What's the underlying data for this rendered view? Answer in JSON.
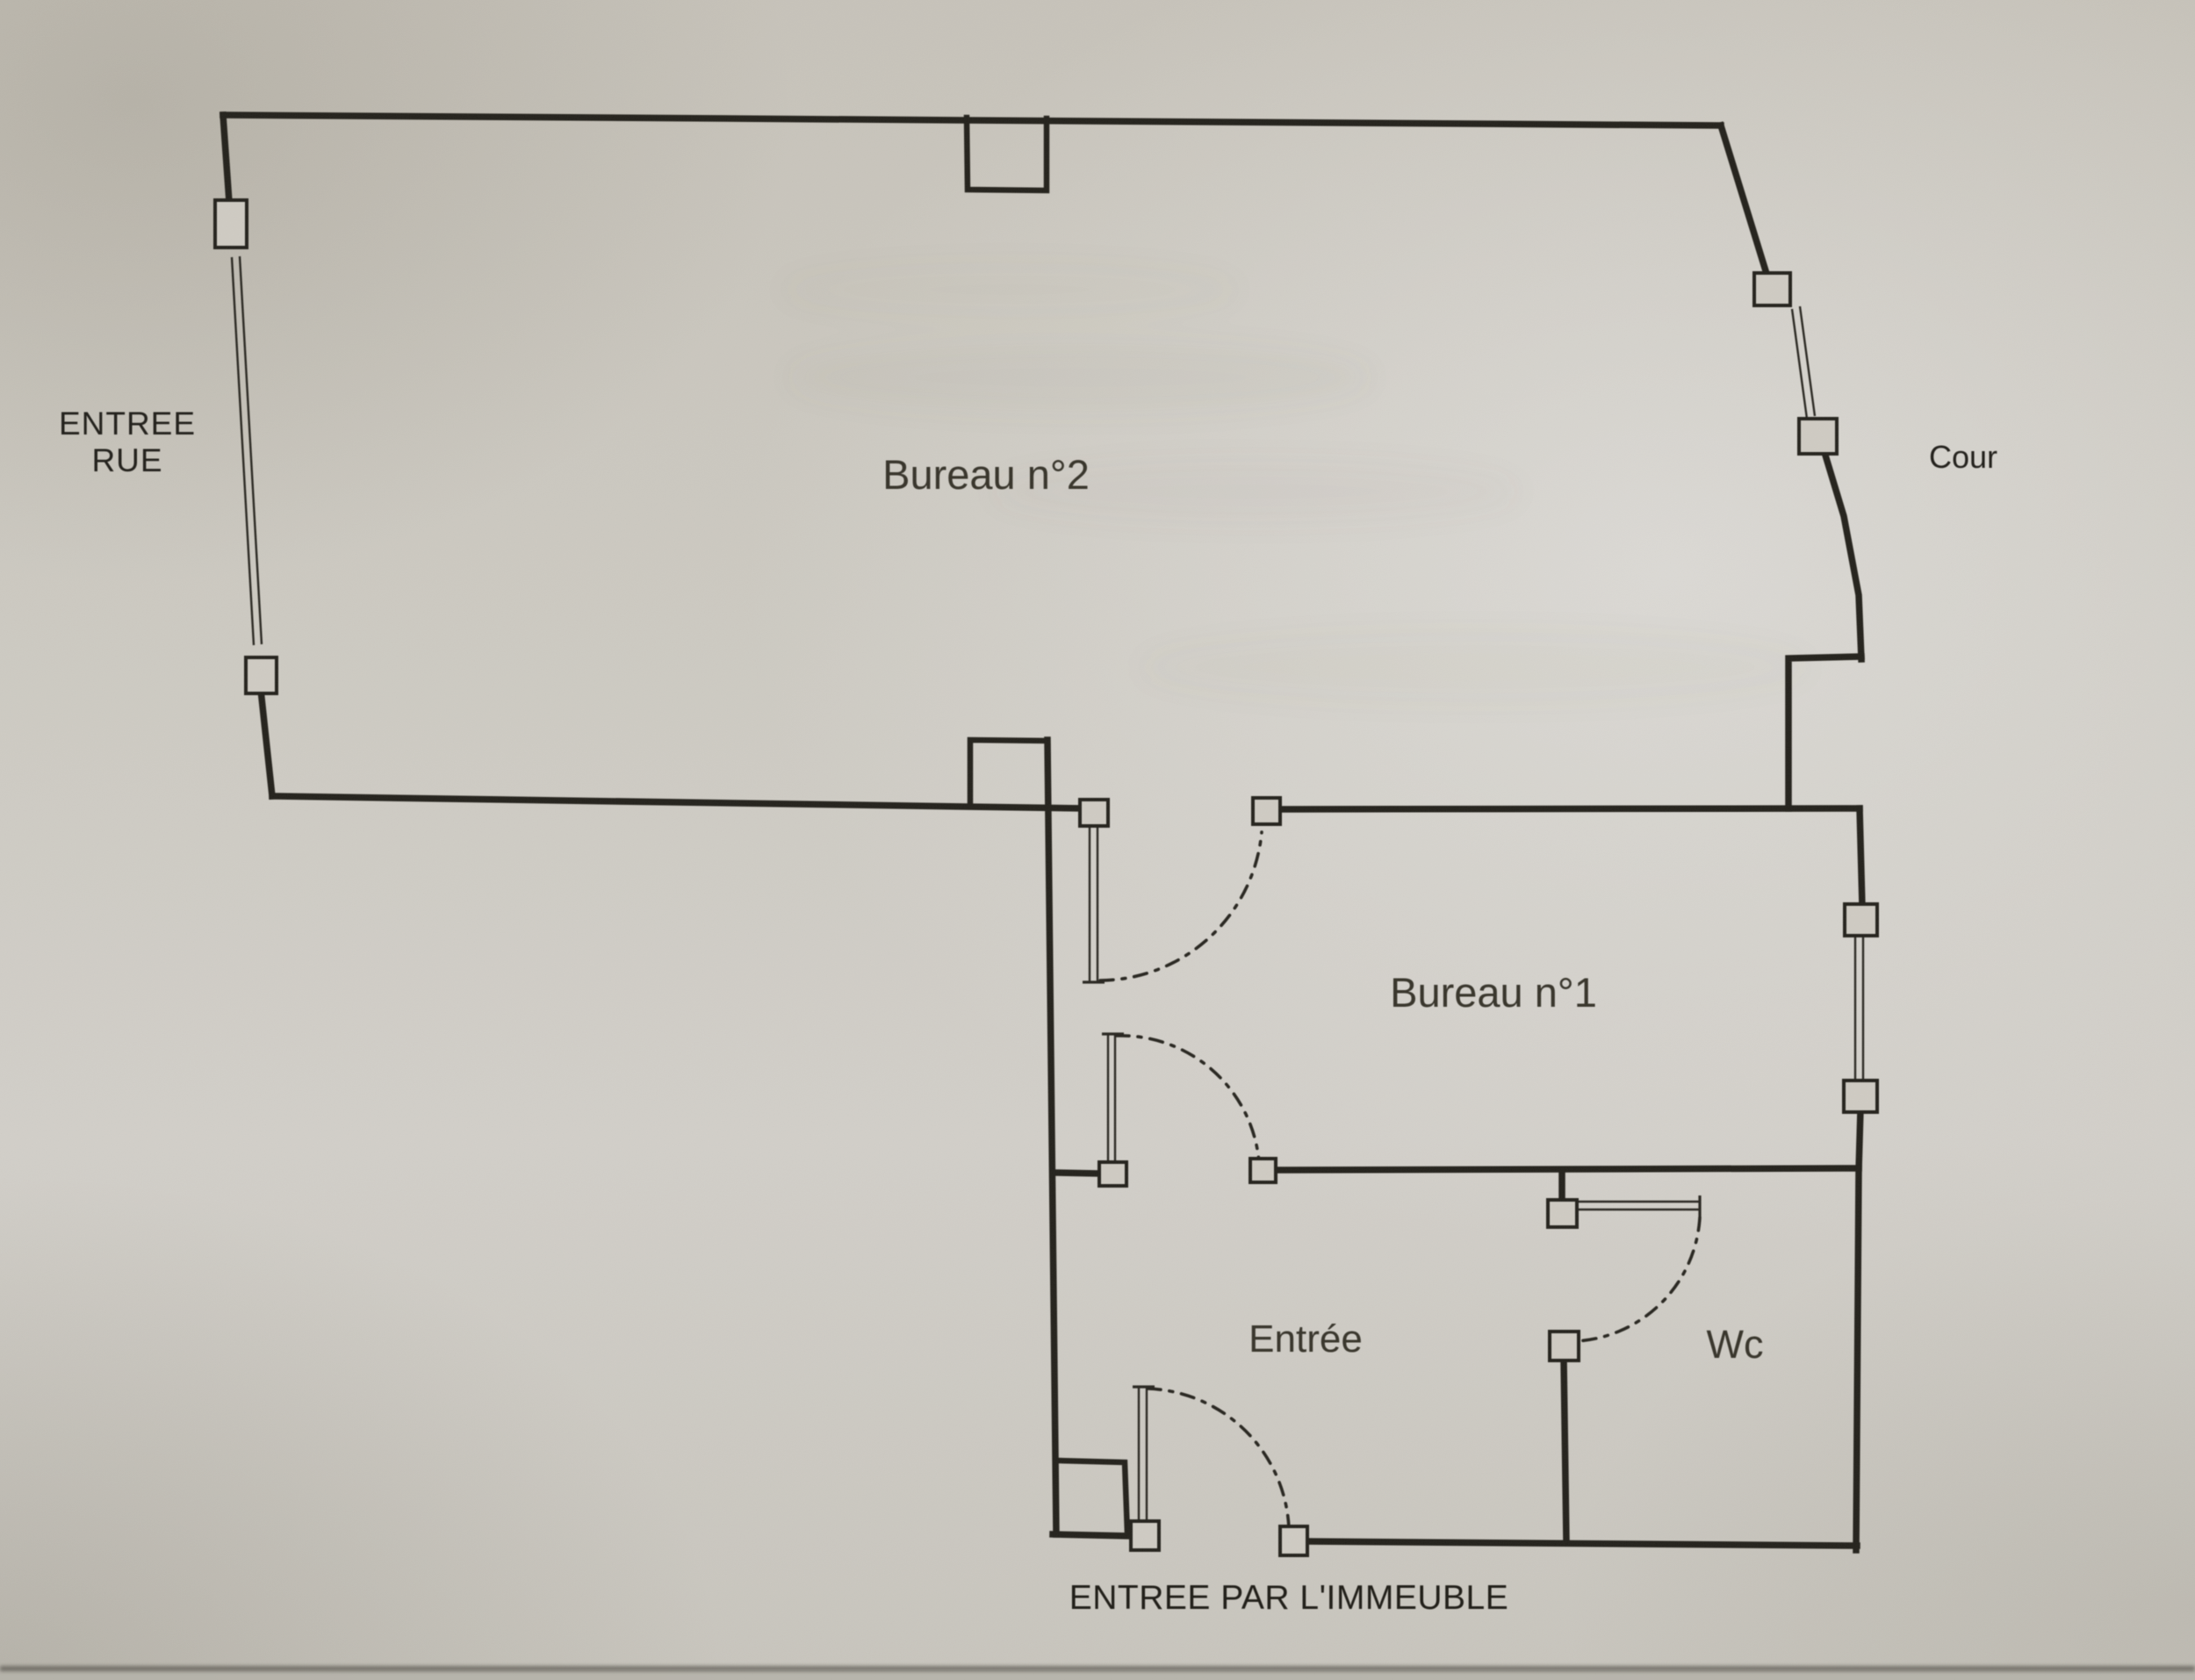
{
  "document": {
    "kind": "scanned floor plan photo"
  },
  "colors": {
    "paper": "#cbc8c0",
    "wall_ink": "#26241e",
    "room_label_ink": "#38352c",
    "caption_ink": "#201e18",
    "paper_edge_shadow": "#54514a"
  },
  "labels": {
    "street_entrance_line1": "ENTREE",
    "street_entrance_line2": "RUE",
    "office2": "Bureau n°2",
    "courtyard": "Cour",
    "office1": "Bureau n°1",
    "hall": "Entrée",
    "wc": "Wc",
    "building_entrance": "ENTREE PAR L'IMMEUBLE"
  }
}
